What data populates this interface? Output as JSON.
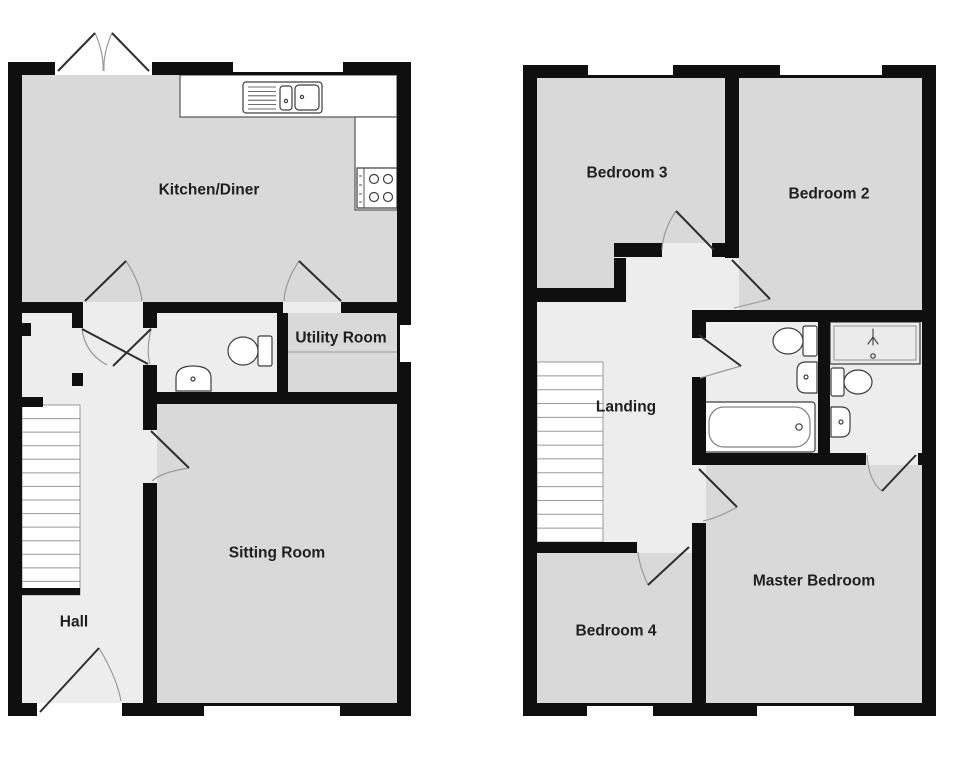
{
  "page": {
    "width": 980,
    "height": 769,
    "background": "#ffffff",
    "label_size": 15.5
  },
  "palette": {
    "wall": "#0f0f0f",
    "room": "#d9d9d9",
    "hall": "#ededed",
    "white": "#ffffff",
    "label": "#1f1f1f",
    "leaf": "#2e2e2e",
    "arc": "#9a9a9a",
    "fixture": "#3d3d3d",
    "stair": "#999999",
    "counter": "#555555"
  },
  "plans": [
    {
      "name": "ground-floor-plan",
      "base": [
        22,
        75,
        375,
        628
      ],
      "rooms": [
        {
          "name": "kitchen-diner",
          "label": "Kitchen/Diner",
          "lx": 209,
          "ly": 190,
          "rects": [
            [
              22,
              75,
              375,
              227
            ]
          ]
        },
        {
          "name": "utility-room",
          "label": "Utility Room",
          "lx": 341,
          "ly": 338,
          "rects": [
            [
              288,
              313,
              109,
              79
            ]
          ]
        },
        {
          "name": "sitting-room",
          "label": "Sitting Room",
          "lx": 277,
          "ly": 553,
          "rects": [
            [
              157,
              404,
              240,
              299
            ]
          ]
        },
        {
          "name": "hall",
          "label": "Hall",
          "lx": 74,
          "ly": 622,
          "rects": []
        }
      ],
      "stairs": {
        "name": "hall-staircase",
        "x": 22,
        "y": 405,
        "w": 58,
        "h": 190,
        "treads": 13,
        "base": 7
      },
      "fixtures": [
        {
          "n": "kitchen-counter",
          "t": "rect",
          "a": [
            180,
            75,
            217,
            42
          ],
          "f": "white",
          "s": "counter"
        },
        {
          "n": "kitchen-counter-return",
          "t": "rect",
          "a": [
            355,
            117,
            42,
            93
          ],
          "f": "white",
          "s": "counter"
        },
        {
          "n": "kitchen-sink-unit",
          "t": "rrect",
          "a": [
            243,
            82,
            79,
            31,
            3
          ],
          "f": "white",
          "s": "fixture"
        },
        {
          "n": "sink-drainer-lines",
          "t": "hlines",
          "a": [
            248,
            276,
            87,
            6,
            4.4
          ],
          "s": "fixture",
          "sw": 0.8
        },
        {
          "n": "sink-basin-small",
          "t": "rrect",
          "a": [
            280,
            86,
            12,
            24,
            3
          ],
          "s": "fixture"
        },
        {
          "n": "sink-basin-main",
          "t": "rrect",
          "a": [
            295,
            85,
            24,
            25,
            4
          ],
          "s": "fixture"
        },
        {
          "n": "sink-tap-dot",
          "t": "circle",
          "a": [
            286,
            101,
            1.6
          ],
          "s": "fixture"
        },
        {
          "n": "sink-drain-dot",
          "t": "circle",
          "a": [
            302,
            97,
            1.6
          ],
          "s": "fixture"
        },
        {
          "n": "hob",
          "t": "rect",
          "a": [
            357,
            168,
            40,
            40
          ],
          "f": "white",
          "s": "fixture"
        },
        {
          "n": "hob-panel-line",
          "t": "line",
          "a": [
            364,
            168,
            364,
            208
          ],
          "s": "fixture",
          "sw": 0.9
        },
        {
          "n": "hob-knob-1",
          "t": "line",
          "a": [
            359,
            176,
            362,
            176
          ],
          "s": "fixture",
          "sw": 0.9
        },
        {
          "n": "hob-knob-2",
          "t": "line",
          "a": [
            359,
            185,
            362,
            185
          ],
          "s": "fixture",
          "sw": 0.9
        },
        {
          "n": "hob-knob-3",
          "t": "line",
          "a": [
            359,
            194,
            362,
            194
          ],
          "s": "fixture",
          "sw": 0.9
        },
        {
          "n": "hob-knob-4",
          "t": "line",
          "a": [
            359,
            202,
            362,
            202
          ],
          "s": "fixture",
          "sw": 0.9
        },
        {
          "n": "hob-burner-1",
          "t": "circle",
          "a": [
            374,
            179,
            4.5
          ],
          "s": "fixture"
        },
        {
          "n": "hob-burner-2",
          "t": "circle",
          "a": [
            388,
            179,
            4.5
          ],
          "s": "fixture"
        },
        {
          "n": "hob-burner-3",
          "t": "circle",
          "a": [
            374,
            197,
            4.5
          ],
          "s": "fixture"
        },
        {
          "n": "hob-burner-4",
          "t": "circle",
          "a": [
            388,
            197,
            4.5
          ],
          "s": "fixture"
        },
        {
          "n": "wc-toilet-cistern",
          "t": "rrect",
          "a": [
            258,
            336,
            14,
            30,
            2
          ],
          "f": "white",
          "s": "fixture"
        },
        {
          "n": "wc-toilet-bowl",
          "t": "ellipse",
          "a": [
            243,
            351,
            15,
            14
          ],
          "f": "white",
          "s": "fixture"
        },
        {
          "n": "wc-basin",
          "t": "path",
          "d": "M176,391 L211,391 L211,378 Q211,366 193,366 Q176,366 176,378 Z",
          "f": "white",
          "s": "fixture"
        },
        {
          "n": "wc-basin-drain",
          "t": "circle",
          "a": [
            193,
            379,
            2
          ],
          "s": "fixture"
        },
        {
          "n": "utility-worktop-line",
          "t": "line",
          "a": [
            288,
            352,
            397,
            352
          ],
          "s": "#a8a8a8",
          "sw": 1.2
        }
      ],
      "walls": [
        [
          8,
          62,
          403,
          13
        ],
        [
          8,
          703,
          403,
          13
        ],
        [
          8,
          62,
          14,
          654
        ],
        [
          397,
          62,
          14,
          654
        ],
        [
          8,
          302,
          403,
          11
        ],
        [
          143,
          302,
          14,
          401
        ],
        [
          143,
          392,
          268,
          12
        ],
        [
          277,
          302,
          11,
          90
        ],
        [
          72,
          313,
          11,
          15
        ],
        [
          18,
          323,
          13,
          13
        ],
        [
          72,
          373,
          11,
          13
        ],
        [
          22,
          397,
          21,
          10
        ]
      ],
      "openings": [
        {
          "name": "patio-door-opening",
          "rect": [
            55,
            62,
            97,
            13
          ],
          "fill": "white"
        },
        {
          "name": "kitchen-window",
          "rect": [
            233,
            62,
            110,
            10
          ],
          "fill": "white"
        },
        {
          "name": "utility-window",
          "rect": [
            400,
            325,
            11,
            37
          ],
          "fill": "white"
        },
        {
          "name": "front-door-opening",
          "rect": [
            37,
            703,
            85,
            13
          ],
          "fill": "white"
        },
        {
          "name": "sitting-room-window",
          "rect": [
            204,
            706,
            136,
            10
          ],
          "fill": "white"
        },
        {
          "name": "kitchen-hall-doorway",
          "rect": [
            83,
            302,
            60,
            11
          ],
          "fill": "hall"
        },
        {
          "name": "utility-doorway",
          "rect": [
            283,
            302,
            58,
            11
          ],
          "fill": "hall"
        },
        {
          "name": "wc-doorway",
          "rect": [
            143,
            328,
            14,
            37
          ],
          "fill": "hall"
        },
        {
          "name": "sitting-room-doorway",
          "rect": [
            143,
            430,
            14,
            53
          ],
          "fill": "hall"
        }
      ],
      "doors": [
        {
          "name": "patio-door-left",
          "leaf": [
            58,
            71,
            95,
            33
          ],
          "arc": "M95,33 Q104,53 103,71"
        },
        {
          "name": "patio-door-right",
          "leaf": [
            149,
            71,
            112,
            33
          ],
          "arc": "M112,33 Q103,53 104,71"
        },
        {
          "name": "kitchen-hall-door",
          "leaf": [
            85,
            301,
            126,
            261
          ],
          "arc": "M126,261 Q140,282 142,301"
        },
        {
          "name": "utility-door",
          "leaf": [
            341,
            301,
            299,
            261
          ],
          "arc": "M299,261 Q285,282 284,301"
        },
        {
          "name": "hall-inner-door",
          "leaf": [
            82,
            329,
            148,
            364
          ],
          "arc": "M82,329 Q85,353 107,365"
        },
        {
          "name": "wc-door",
          "leaf": [
            151,
            329,
            113,
            366
          ],
          "arc": "M151,329 Q146,351 150,364"
        },
        {
          "name": "sitting-room-door",
          "leaf": [
            151,
            431,
            189,
            468
          ],
          "arc": "M189,468 Q162,472 152,481"
        },
        {
          "name": "front-door",
          "leaf": [
            40,
            712,
            99,
            648
          ],
          "arc": "M99,648 Q117,678 121,701"
        }
      ]
    },
    {
      "name": "first-floor-plan",
      "base": [
        537,
        78,
        385,
        625
      ],
      "rooms": [
        {
          "name": "bedroom-3",
          "label": "Bedroom 3",
          "lx": 627,
          "ly": 173,
          "rects": [
            [
              537,
              78,
              188,
              165
            ],
            [
              537,
              243,
              77,
              45
            ]
          ]
        },
        {
          "name": "bedroom-2",
          "label": "Bedroom 2",
          "lx": 829,
          "ly": 194,
          "rects": [
            [
              739,
              78,
              183,
              232
            ]
          ]
        },
        {
          "name": "landing",
          "label": "Landing",
          "lx": 626,
          "ly": 407,
          "rects": []
        },
        {
          "name": "bedroom-4",
          "label": "Bedroom 4",
          "lx": 616,
          "ly": 631,
          "rects": [
            [
              537,
              553,
              155,
              150
            ]
          ]
        },
        {
          "name": "master-bedroom",
          "label": "Master Bedroom",
          "lx": 814,
          "ly": 581,
          "rects": [
            [
              706,
              465,
              216,
              238
            ]
          ]
        }
      ],
      "stairs": {
        "name": "landing-staircase",
        "x": 537,
        "y": 362,
        "w": 66,
        "h": 180,
        "treads": 12,
        "base": 0
      },
      "fixtures": [
        {
          "n": "bathroom-toilet-cistern",
          "t": "rrect",
          "a": [
            803,
            326,
            14,
            30,
            2
          ],
          "f": "white",
          "s": "fixture"
        },
        {
          "n": "bathroom-toilet-bowl",
          "t": "ellipse",
          "a": [
            788,
            341,
            15,
            13
          ],
          "f": "white",
          "s": "fixture"
        },
        {
          "n": "bathroom-basin",
          "t": "path",
          "d": "M817,362 L817,393 L806,393 Q797,393 797,384 L797,371 Q797,362 806,362 Z",
          "f": "white",
          "s": "fixture"
        },
        {
          "n": "bathroom-basin-drain",
          "t": "circle",
          "a": [
            806,
            377,
            2
          ],
          "s": "fixture"
        },
        {
          "n": "bathtub",
          "t": "rrect",
          "a": [
            704,
            402,
            111,
            50,
            3
          ],
          "f": "white",
          "s": "fixture"
        },
        {
          "n": "bathtub-inner",
          "t": "rrect",
          "a": [
            709,
            407,
            101,
            40,
            15
          ],
          "s": "#808080"
        },
        {
          "n": "bathtub-tap",
          "t": "circle",
          "a": [
            799,
            427,
            3.2
          ],
          "s": "fixture"
        },
        {
          "n": "shower-tray",
          "t": "rect",
          "a": [
            830,
            322,
            90,
            42
          ],
          "f": "#ebebeb",
          "s": "fixture"
        },
        {
          "n": "shower-tray-inner",
          "t": "rect",
          "a": [
            834,
            326,
            82,
            34
          ],
          "s": "#8a8a8a",
          "sw": 0.9
        },
        {
          "n": "shower-head-icon",
          "t": "path",
          "d": "M873,329 L873,337 M868,344 L873,337 M878,344 L873,337 M873,345 L873,337",
          "s": "fixture",
          "sw": 1.1
        },
        {
          "n": "shower-drain",
          "t": "circle",
          "a": [
            873,
            356,
            2.2
          ],
          "s": "fixture"
        },
        {
          "n": "ensuite-toilet-cistern",
          "t": "rrect",
          "a": [
            831,
            368,
            13,
            28,
            2
          ],
          "f": "white",
          "s": "fixture"
        },
        {
          "n": "ensuite-toilet-bowl",
          "t": "ellipse",
          "a": [
            858,
            382,
            14,
            12
          ],
          "f": "white",
          "s": "fixture"
        },
        {
          "n": "ensuite-basin",
          "t": "path",
          "d": "M831,407 L831,437 L841,437 Q850,437 850,428 L850,416 Q850,407 841,407 Z",
          "f": "white",
          "s": "fixture"
        },
        {
          "n": "ensuite-basin-drain",
          "t": "circle",
          "a": [
            841,
            422,
            2
          ],
          "s": "fixture"
        }
      ],
      "walls": [
        [
          523,
          65,
          413,
          13
        ],
        [
          523,
          703,
          413,
          13
        ],
        [
          523,
          65,
          14,
          651
        ],
        [
          922,
          65,
          14,
          651
        ],
        [
          725,
          78,
          14,
          180
        ],
        [
          712,
          243,
          27,
          14
        ],
        [
          614,
          243,
          48,
          14
        ],
        [
          614,
          258,
          12,
          44
        ],
        [
          523,
          288,
          95,
          14
        ],
        [
          692,
          310,
          230,
          12
        ],
        [
          692,
          322,
          14,
          16
        ],
        [
          692,
          338,
          14,
          365
        ],
        [
          818,
          322,
          12,
          131
        ],
        [
          692,
          453,
          230,
          12
        ],
        [
          523,
          542,
          169,
          11
        ]
      ],
      "openings": [
        {
          "name": "bedroom-3-window",
          "rect": [
            588,
            65,
            85,
            10
          ],
          "fill": "white"
        },
        {
          "name": "bedroom-2-window",
          "rect": [
            780,
            65,
            102,
            10
          ],
          "fill": "white"
        },
        {
          "name": "bedroom-4-window",
          "rect": [
            587,
            706,
            66,
            10
          ],
          "fill": "white"
        },
        {
          "name": "master-bedroom-window",
          "rect": [
            757,
            706,
            97,
            10
          ],
          "fill": "white"
        },
        {
          "name": "bathroom-doorway",
          "rect": [
            692,
            338,
            14,
            39
          ],
          "fill": "hall"
        },
        {
          "name": "master-bedroom-doorway",
          "rect": [
            692,
            465,
            14,
            58
          ],
          "fill": "hall"
        },
        {
          "name": "bedroom-4-doorway",
          "rect": [
            637,
            542,
            55,
            11
          ],
          "fill": "hall"
        },
        {
          "name": "ensuite-doorway",
          "rect": [
            866,
            453,
            52,
            12
          ],
          "fill": "hall"
        }
      ],
      "doors": [
        {
          "name": "bedroom-3-door",
          "leaf": [
            714,
            250,
            676,
            211
          ],
          "arc": "M676,211 Q663,230 662,250"
        },
        {
          "name": "bedroom-2-door",
          "leaf": [
            732,
            260,
            770,
            299
          ],
          "arc": "M770,299 Q747,305 734,308"
        },
        {
          "name": "bathroom-door",
          "leaf": [
            699,
            335,
            741,
            366
          ],
          "arc": "M741,366 Q713,374 700,378"
        },
        {
          "name": "master-bedroom-door",
          "leaf": [
            699,
            469,
            737,
            507
          ],
          "arc": "M737,507 Q718,518 703,521"
        },
        {
          "name": "bedroom-4-door",
          "leaf": [
            689,
            547,
            648,
            585
          ],
          "arc": "M648,585 Q639,565 638,552"
        },
        {
          "name": "ensuite-door",
          "leaf": [
            916,
            455,
            882,
            491
          ],
          "arc": "M867,455 Q869,482 882,491"
        }
      ]
    }
  ]
}
